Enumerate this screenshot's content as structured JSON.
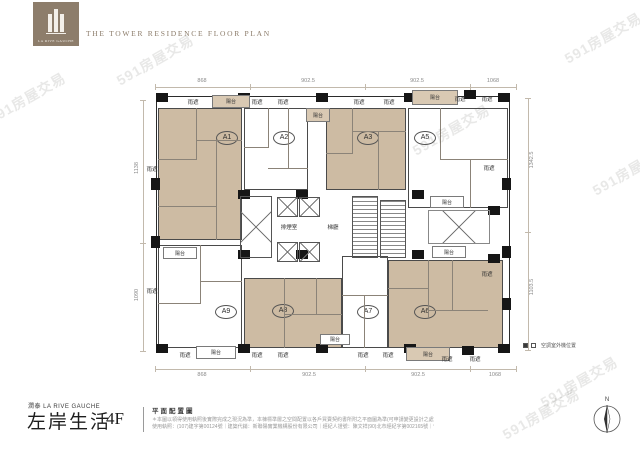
{
  "header": {
    "brand": "LA RIVE GAUCHE",
    "title": "THE TOWER RESIDENCE FLOOR PLAN"
  },
  "watermark_text": "591房屋交易",
  "watermarks": [
    {
      "x": -16,
      "y": 88
    },
    {
      "x": 112,
      "y": 50
    },
    {
      "x": 408,
      "y": 120
    },
    {
      "x": 560,
      "y": 28
    },
    {
      "x": 588,
      "y": 160
    },
    {
      "x": 536,
      "y": 372
    },
    {
      "x": 498,
      "y": 404
    }
  ],
  "plan": {
    "units": [
      {
        "id": "A1",
        "fill": "tan",
        "x": 158,
        "y": 108,
        "w": 84,
        "h": 132,
        "lx": 226,
        "ly": 137
      },
      {
        "id": "A2",
        "fill": "white",
        "x": 244,
        "y": 108,
        "w": 64,
        "h": 82,
        "lx": 283,
        "ly": 137
      },
      {
        "id": "A3",
        "fill": "tan",
        "x": 326,
        "y": 108,
        "w": 80,
        "h": 82,
        "lx": 367,
        "ly": 137
      },
      {
        "id": "A5",
        "fill": "white",
        "x": 408,
        "y": 108,
        "w": 100,
        "h": 100,
        "lx": 424,
        "ly": 137
      },
      {
        "id": "A9",
        "fill": "white",
        "x": 158,
        "y": 245,
        "w": 84,
        "h": 103,
        "lx": 225,
        "ly": 311
      },
      {
        "id": "A8",
        "fill": "tan",
        "x": 244,
        "y": 278,
        "w": 98,
        "h": 70,
        "lx": 282,
        "ly": 310
      },
      {
        "id": "A7",
        "fill": "white",
        "x": 342,
        "y": 256,
        "w": 46,
        "h": 92,
        "lx": 367,
        "ly": 311
      },
      {
        "id": "A6",
        "fill": "tan",
        "x": 388,
        "y": 260,
        "w": 115,
        "h": 88,
        "lx": 424,
        "ly": 311
      }
    ],
    "walls": [
      [
        196,
        108,
        1,
        52
      ],
      [
        158,
        159,
        39,
        1
      ],
      [
        196,
        140,
        46,
        1
      ],
      [
        216,
        141,
        1,
        99
      ],
      [
        158,
        206,
        58,
        1
      ],
      [
        268,
        108,
        1,
        40
      ],
      [
        244,
        147,
        25,
        1
      ],
      [
        268,
        168,
        40,
        1
      ],
      [
        288,
        108,
        1,
        60
      ],
      [
        352,
        108,
        1,
        46
      ],
      [
        326,
        153,
        27,
        1
      ],
      [
        352,
        131,
        54,
        1
      ],
      [
        378,
        131,
        1,
        59
      ],
      [
        440,
        108,
        1,
        52
      ],
      [
        440,
        159,
        68,
        1
      ],
      [
        470,
        159,
        1,
        49
      ],
      [
        200,
        245,
        1,
        58
      ],
      [
        158,
        303,
        43,
        1
      ],
      [
        200,
        281,
        42,
        1
      ],
      [
        284,
        278,
        1,
        70
      ],
      [
        284,
        314,
        58,
        1
      ],
      [
        316,
        278,
        1,
        37
      ],
      [
        342,
        295,
        46,
        1
      ],
      [
        364,
        295,
        1,
        53
      ],
      [
        428,
        260,
        1,
        58
      ],
      [
        428,
        310,
        60,
        1
      ],
      [
        452,
        260,
        1,
        50
      ],
      [
        388,
        288,
        41,
        1
      ]
    ],
    "columns": [
      [
        156,
        93
      ],
      [
        238,
        93
      ],
      [
        316,
        93
      ],
      [
        404,
        93
      ],
      [
        464,
        90
      ],
      [
        498,
        93
      ],
      [
        156,
        344
      ],
      [
        238,
        344
      ],
      [
        316,
        344
      ],
      [
        404,
        344
      ],
      [
        462,
        346
      ],
      [
        498,
        344
      ],
      [
        151,
        178,
        9,
        12
      ],
      [
        151,
        236,
        9,
        12
      ],
      [
        502,
        178,
        9,
        12
      ],
      [
        502,
        246,
        9,
        12
      ],
      [
        502,
        298,
        9,
        12
      ],
      [
        238,
        190
      ],
      [
        296,
        190
      ],
      [
        238,
        250
      ],
      [
        296,
        250
      ],
      [
        412,
        190
      ],
      [
        412,
        250
      ],
      [
        488,
        206
      ],
      [
        488,
        254
      ]
    ],
    "core": {
      "shaft": {
        "x": 240,
        "y": 196,
        "w": 32,
        "h": 62
      },
      "elevators": [
        [
          277,
          197,
          21,
          20
        ],
        [
          299,
          197,
          21,
          20
        ],
        [
          277,
          242,
          21,
          20
        ],
        [
          299,
          242,
          21,
          20
        ]
      ],
      "stairs": [
        [
          352,
          196,
          26,
          62
        ],
        [
          380,
          200,
          26,
          58
        ]
      ],
      "lightwell": {
        "x": 428,
        "y": 210,
        "w": 62,
        "h": 34
      },
      "labels": [
        {
          "name": "smoke-room-label",
          "t": "排煙室",
          "x": 289,
          "y": 223
        },
        {
          "name": "lobby-label",
          "t": "梯廳",
          "x": 333,
          "y": 223
        }
      ]
    },
    "balconies": [
      {
        "t": "陽台",
        "x": 212,
        "y": 95,
        "w": 38,
        "h": 13,
        "tan": 1
      },
      {
        "t": "陽台",
        "x": 412,
        "y": 90,
        "w": 46,
        "h": 15,
        "tan": 1
      },
      {
        "t": "陽台",
        "x": 306,
        "y": 108,
        "w": 24,
        "h": 14,
        "tan": 1
      },
      {
        "t": "陽台",
        "x": 430,
        "y": 196,
        "w": 34,
        "h": 12
      },
      {
        "t": "陽台",
        "x": 432,
        "y": 246,
        "w": 34,
        "h": 12
      },
      {
        "t": "陽台",
        "x": 163,
        "y": 247,
        "w": 34,
        "h": 12
      },
      {
        "t": "陽台",
        "x": 196,
        "y": 346,
        "w": 40,
        "h": 13
      },
      {
        "t": "陽台",
        "x": 320,
        "y": 334,
        "w": 30,
        "h": 11
      },
      {
        "t": "陽台",
        "x": 406,
        "y": 347,
        "w": 44,
        "h": 14,
        "tan": 1
      }
    ],
    "canopies": [
      {
        "t": "雨遮",
        "x": 193,
        "y": 98
      },
      {
        "t": "雨遮",
        "x": 257,
        "y": 98
      },
      {
        "t": "雨遮",
        "x": 283,
        "y": 98
      },
      {
        "t": "雨遮",
        "x": 359,
        "y": 98
      },
      {
        "t": "雨遮",
        "x": 389,
        "y": 98
      },
      {
        "t": "雨遮",
        "x": 460,
        "y": 95
      },
      {
        "t": "雨遮",
        "x": 487,
        "y": 95
      },
      {
        "t": "雨遮",
        "x": 185,
        "y": 351
      },
      {
        "t": "雨遮",
        "x": 257,
        "y": 351
      },
      {
        "t": "雨遮",
        "x": 283,
        "y": 351
      },
      {
        "t": "雨遮",
        "x": 363,
        "y": 351
      },
      {
        "t": "雨遮",
        "x": 388,
        "y": 351
      },
      {
        "t": "雨遮",
        "x": 447,
        "y": 355
      },
      {
        "t": "雨遮",
        "x": 475,
        "y": 355
      },
      {
        "t": "雨遮",
        "x": 152,
        "y": 165
      },
      {
        "t": "雨遮",
        "x": 152,
        "y": 287
      },
      {
        "t": "雨遮",
        "x": 489,
        "y": 164
      },
      {
        "t": "雨遮",
        "x": 487,
        "y": 270
      }
    ],
    "dim_lines": [
      [
        155,
        87,
        362,
        1
      ],
      [
        155,
        369,
        362,
        1
      ],
      [
        143,
        100,
        1,
        252
      ],
      [
        528,
        98,
        1,
        252
      ],
      [
        155,
        84,
        1,
        6
      ],
      [
        250,
        84,
        1,
        6
      ],
      [
        365,
        84,
        1,
        6
      ],
      [
        470,
        84,
        1,
        6
      ],
      [
        516,
        84,
        1,
        6
      ],
      [
        155,
        366,
        1,
        6
      ],
      [
        250,
        366,
        1,
        6
      ],
      [
        365,
        366,
        1,
        6
      ],
      [
        470,
        366,
        1,
        6
      ],
      [
        516,
        366,
        1,
        6
      ],
      [
        140,
        100,
        6,
        1
      ],
      [
        140,
        243,
        6,
        1
      ],
      [
        140,
        351,
        6,
        1
      ],
      [
        525,
        98,
        6,
        1
      ],
      [
        525,
        232,
        6,
        1
      ],
      [
        525,
        350,
        6,
        1
      ]
    ],
    "dim_labels": [
      {
        "t": "868",
        "x": 202,
        "y": 81
      },
      {
        "t": "902.5",
        "x": 308,
        "y": 81
      },
      {
        "t": "902.5",
        "x": 417,
        "y": 81
      },
      {
        "t": "1068",
        "x": 493,
        "y": 81
      },
      {
        "t": "868",
        "x": 202,
        "y": 375
      },
      {
        "t": "902.5",
        "x": 309,
        "y": 375
      },
      {
        "t": "902.5",
        "x": 418,
        "y": 375
      },
      {
        "t": "1068",
        "x": 495,
        "y": 375
      },
      {
        "t": "1138",
        "x": 137,
        "y": 168,
        "r": 1
      },
      {
        "t": "1090",
        "x": 137,
        "y": 295,
        "r": 1
      },
      {
        "t": "1342.5",
        "x": 532,
        "y": 160,
        "r": 1
      },
      {
        "t": "1103.5",
        "x": 532,
        "y": 287,
        "r": 1
      }
    ],
    "legend_text": "空調室外機位置",
    "compass_n": "N"
  },
  "footer": {
    "brand_small": "潤泰 LA RIVE GAUCHE",
    "name_cn": "左岸生活",
    "floor": "4F",
    "plan_label": "平面配置圖",
    "fine1": "＊本圖以領得使用執照後實際完成之現況為準，本棟標準層之空間配置以各戶買賣契約書所附之平面圖為準(可申請變更設計之處)",
    "fine2": "使用執照：(107)建字第00124號｜建築代銷：新聯陽實業機構股份有限公司｜經紀人證號：陳文祥(90)北市經紀字第002165號｜刊登日期 2023/1/3"
  }
}
